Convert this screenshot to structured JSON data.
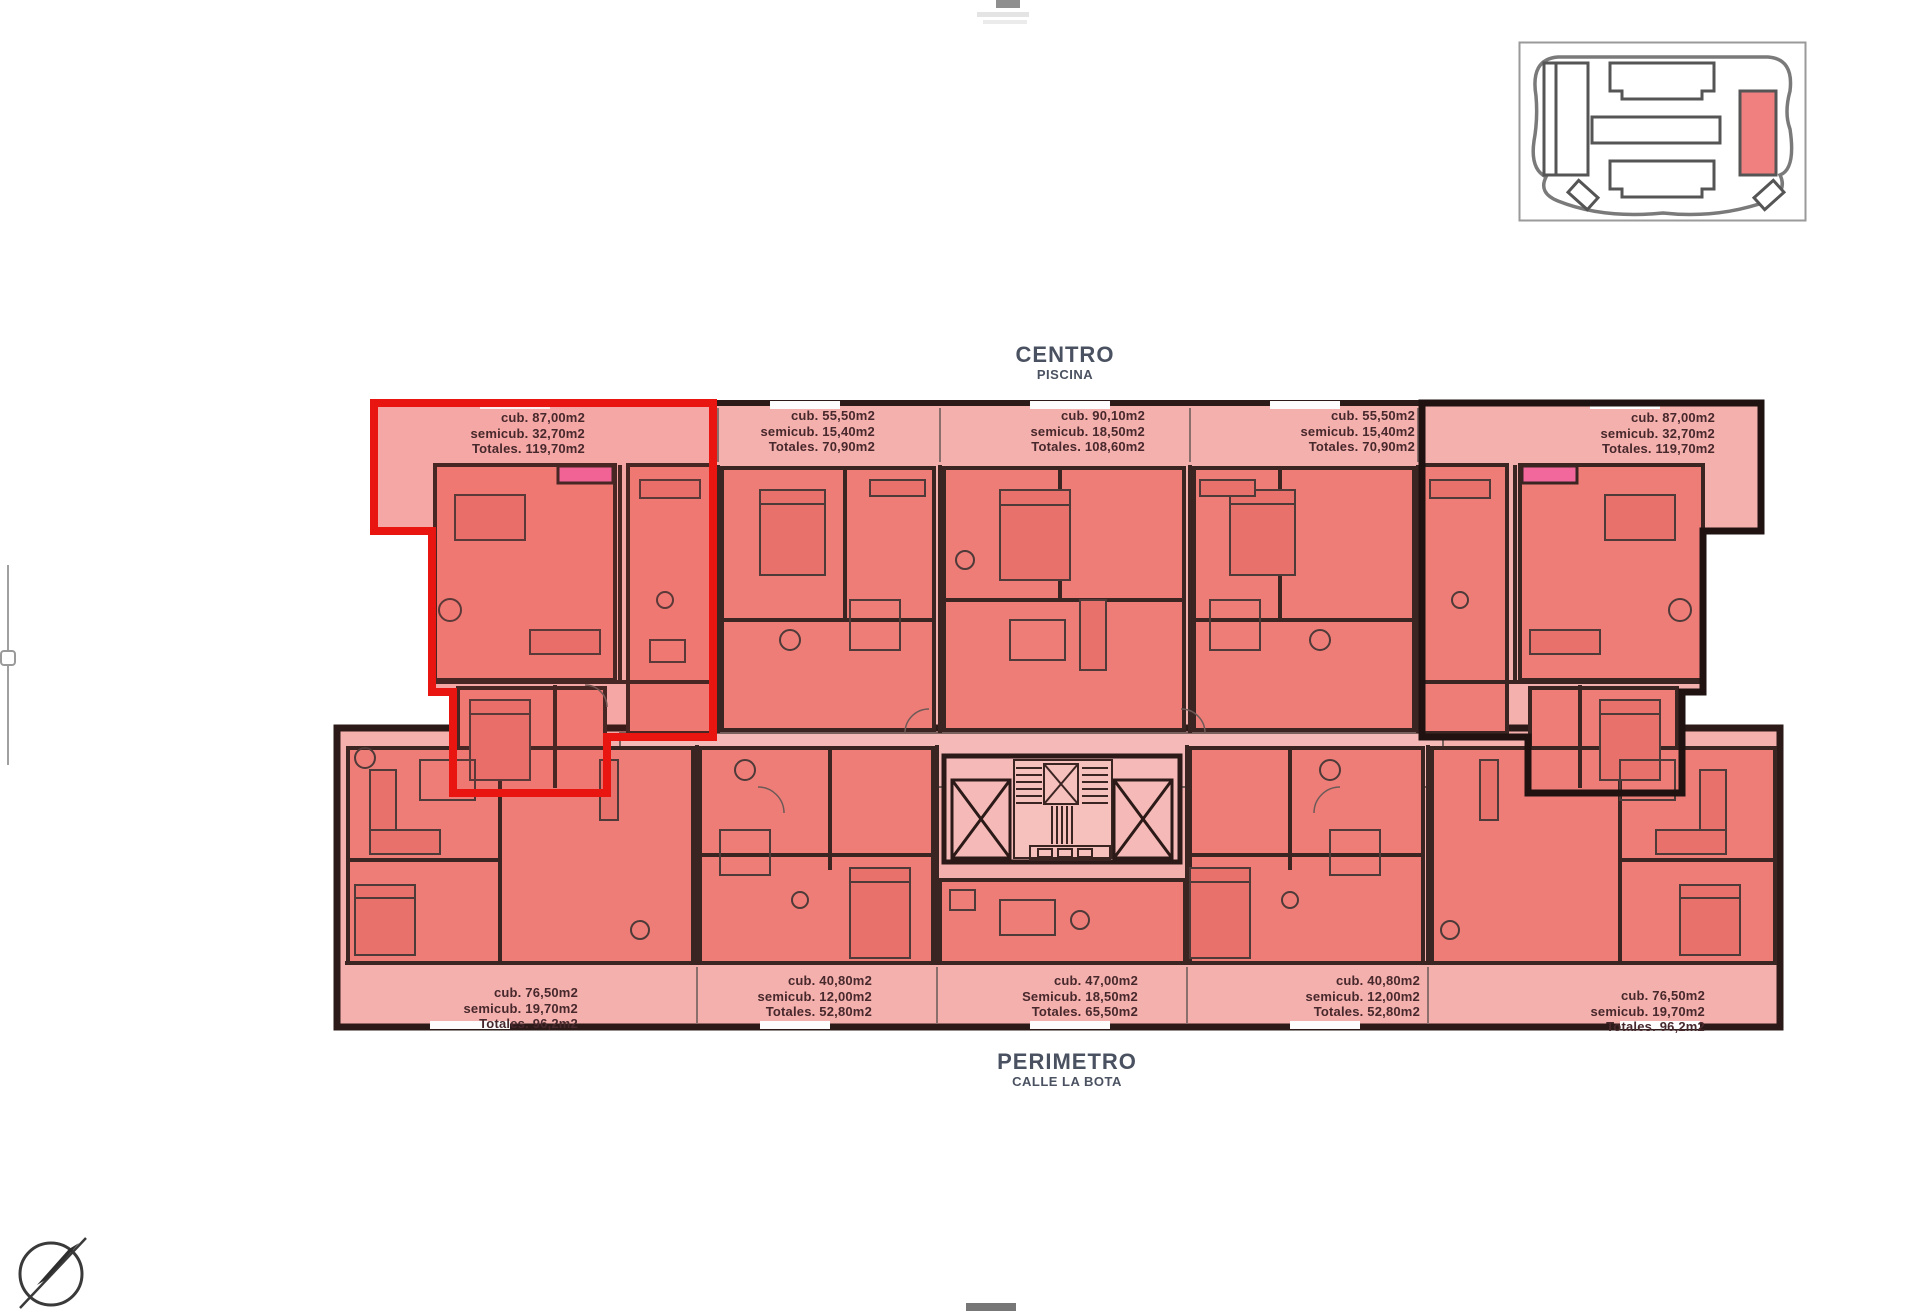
{
  "app": {
    "background": "#ffffff"
  },
  "titles": {
    "top": {
      "main": "CENTRO",
      "sub": "PISCINA"
    },
    "bottom": {
      "main": "PERIMETRO",
      "sub": "CALLE LA BOTA"
    }
  },
  "plan": {
    "colors": {
      "terrace_pink": "#f4b0ad",
      "room_red": "#ee7d78",
      "wall_dark": "#2b1a18",
      "highlight_red": "#e81511",
      "door_pink": "#f2679c"
    },
    "top_units": [
      {
        "cub": "cub. 87,00m2",
        "semicub": "semicub. 32,70m2",
        "totales": "Totales. 119,70m2"
      },
      {
        "cub": "cub. 55,50m2",
        "semicub": "semicub. 15,40m2",
        "totales": "Totales. 70,90m2"
      },
      {
        "cub": "cub. 90,10m2",
        "semicub": "semicub. 18,50m2",
        "totales": "Totales. 108,60m2"
      },
      {
        "cub": "cub. 55,50m2",
        "semicub": "semicub. 15,40m2",
        "totales": "Totales. 70,90m2"
      },
      {
        "cub": "cub. 87,00m2",
        "semicub": "semicub. 32,70m2",
        "totales": "Totales. 119,70m2"
      }
    ],
    "bottom_units": [
      {
        "cub": "cub. 76,50m2",
        "semicub": "semicub. 19,70m2",
        "totales": "Totales. 96,2m2"
      },
      {
        "cub": "cub. 40,80m2",
        "semicub": "semicub. 12,00m2",
        "totales": "Totales. 52,80m2"
      },
      {
        "cub": "cub. 47,00m2",
        "semicub": "Semicub. 18,50m2",
        "totales": "Totales. 65,50m2"
      },
      {
        "cub": "cub. 40,80m2",
        "semicub": "semicub. 12,00m2",
        "totales": "Totales. 52,80m2"
      },
      {
        "cub": "cub. 76,50m2",
        "semicub": "semicub. 19,70m2",
        "totales": "Totales. 96,2m2"
      }
    ]
  },
  "key_plan": {
    "highlight_color": "#f0807f"
  },
  "compass": {
    "type": "north-arrow"
  }
}
